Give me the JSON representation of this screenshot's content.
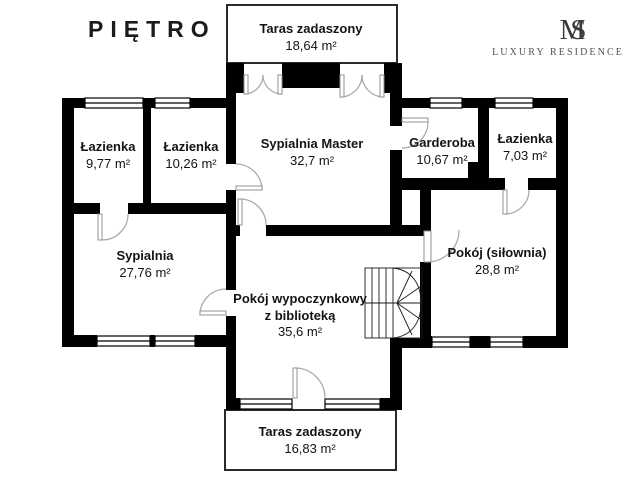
{
  "title": "PIĘTRO",
  "brand": {
    "monogram": "MS",
    "name": "LUXURY RESIDENCE"
  },
  "rooms": [
    {
      "name": "Taras zadaszony",
      "area": "18,64 m²"
    },
    {
      "name": "Łazienka",
      "area": "9,77 m²"
    },
    {
      "name": "Łazienka",
      "area": "10,26 m²"
    },
    {
      "name": "Sypialnia Master",
      "area": "32,7 m²"
    },
    {
      "name": "Garderoba",
      "area": "10,67 m²"
    },
    {
      "name": "Łazienka",
      "area": "7,03 m²"
    },
    {
      "name": "Sypialnia",
      "area": "27,76 m²"
    },
    {
      "name": "Pokój (siłownia)",
      "area": "28,8 m²"
    },
    {
      "name": "Pokój wypoczynkowy",
      "name2": "z biblioteką",
      "area": "35,6 m²"
    },
    {
      "name": "Taras zadaszony",
      "area": "16,83 m²"
    }
  ],
  "colors": {
    "wall": "#000000",
    "terrace_outline": "#2a2a2a",
    "door_arc": "#ababab",
    "door_leaf_stroke": "#909090",
    "text": "#141414",
    "brand_text": "#585052"
  }
}
